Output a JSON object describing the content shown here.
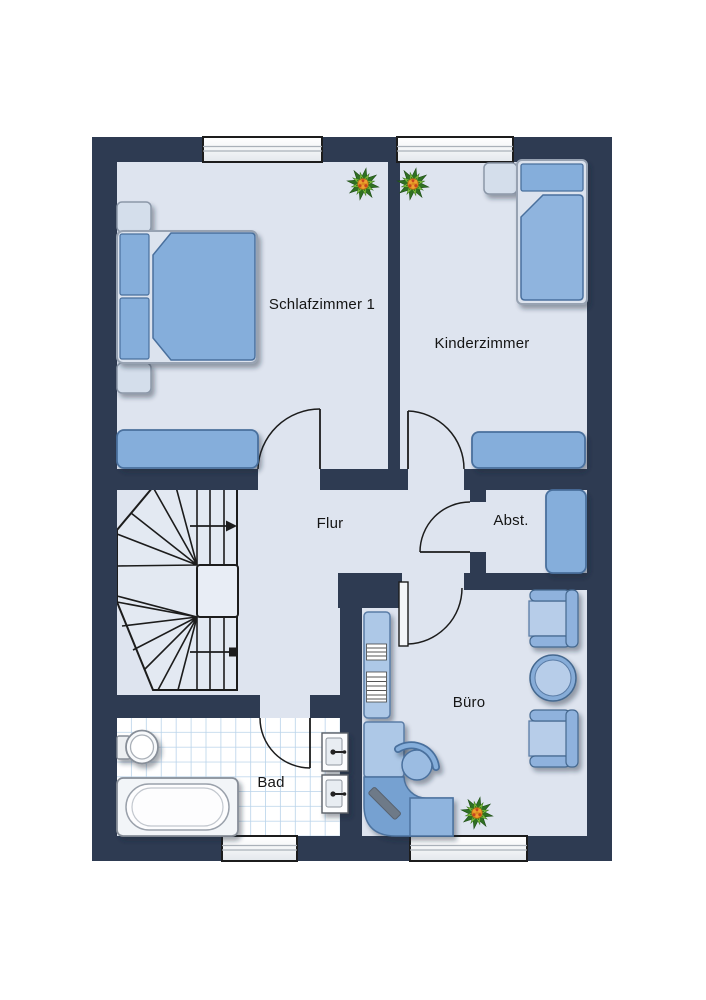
{
  "rooms": {
    "schlafzimmer": {
      "label": "Schlafzimmer 1"
    },
    "kinderzimmer": {
      "label": "Kinderzimmer"
    },
    "flur": {
      "label": "Flur"
    },
    "abstellraum": {
      "label": "Abst."
    },
    "buero": {
      "label": "Büro"
    },
    "bad": {
      "label": "Bad"
    }
  },
  "colors": {
    "wall": "#2e3b52",
    "floor": "#dee4ef",
    "furniture_blue": "#85aedb",
    "furniture_blue_light": "#b7cde9",
    "furniture_outline": "#4a6f9d",
    "frame_light": "#dce3ee",
    "tile_line": "#b9d3ea",
    "plant_green": "#7fbf3b",
    "plant_center": "#e09025"
  },
  "legend": {
    "furniture_icons": {
      "schlafzimmer": [
        "double-bed",
        "nightstand",
        "nightstand",
        "bench",
        "plant"
      ],
      "kinderzimmer": [
        "single-bed",
        "nightstand",
        "bench",
        "plant"
      ],
      "flur": [
        "winder-staircase",
        "stair-direction-arrow"
      ],
      "abstellraum": [
        "cabinet"
      ],
      "buero": [
        "bookshelf",
        "corner-desk",
        "office-chair",
        "armchair",
        "round-table",
        "armchair",
        "plant"
      ],
      "bad": [
        "toilet",
        "bathtub",
        "sink",
        "sink"
      ]
    },
    "window_count": 4,
    "door_count": 5
  }
}
